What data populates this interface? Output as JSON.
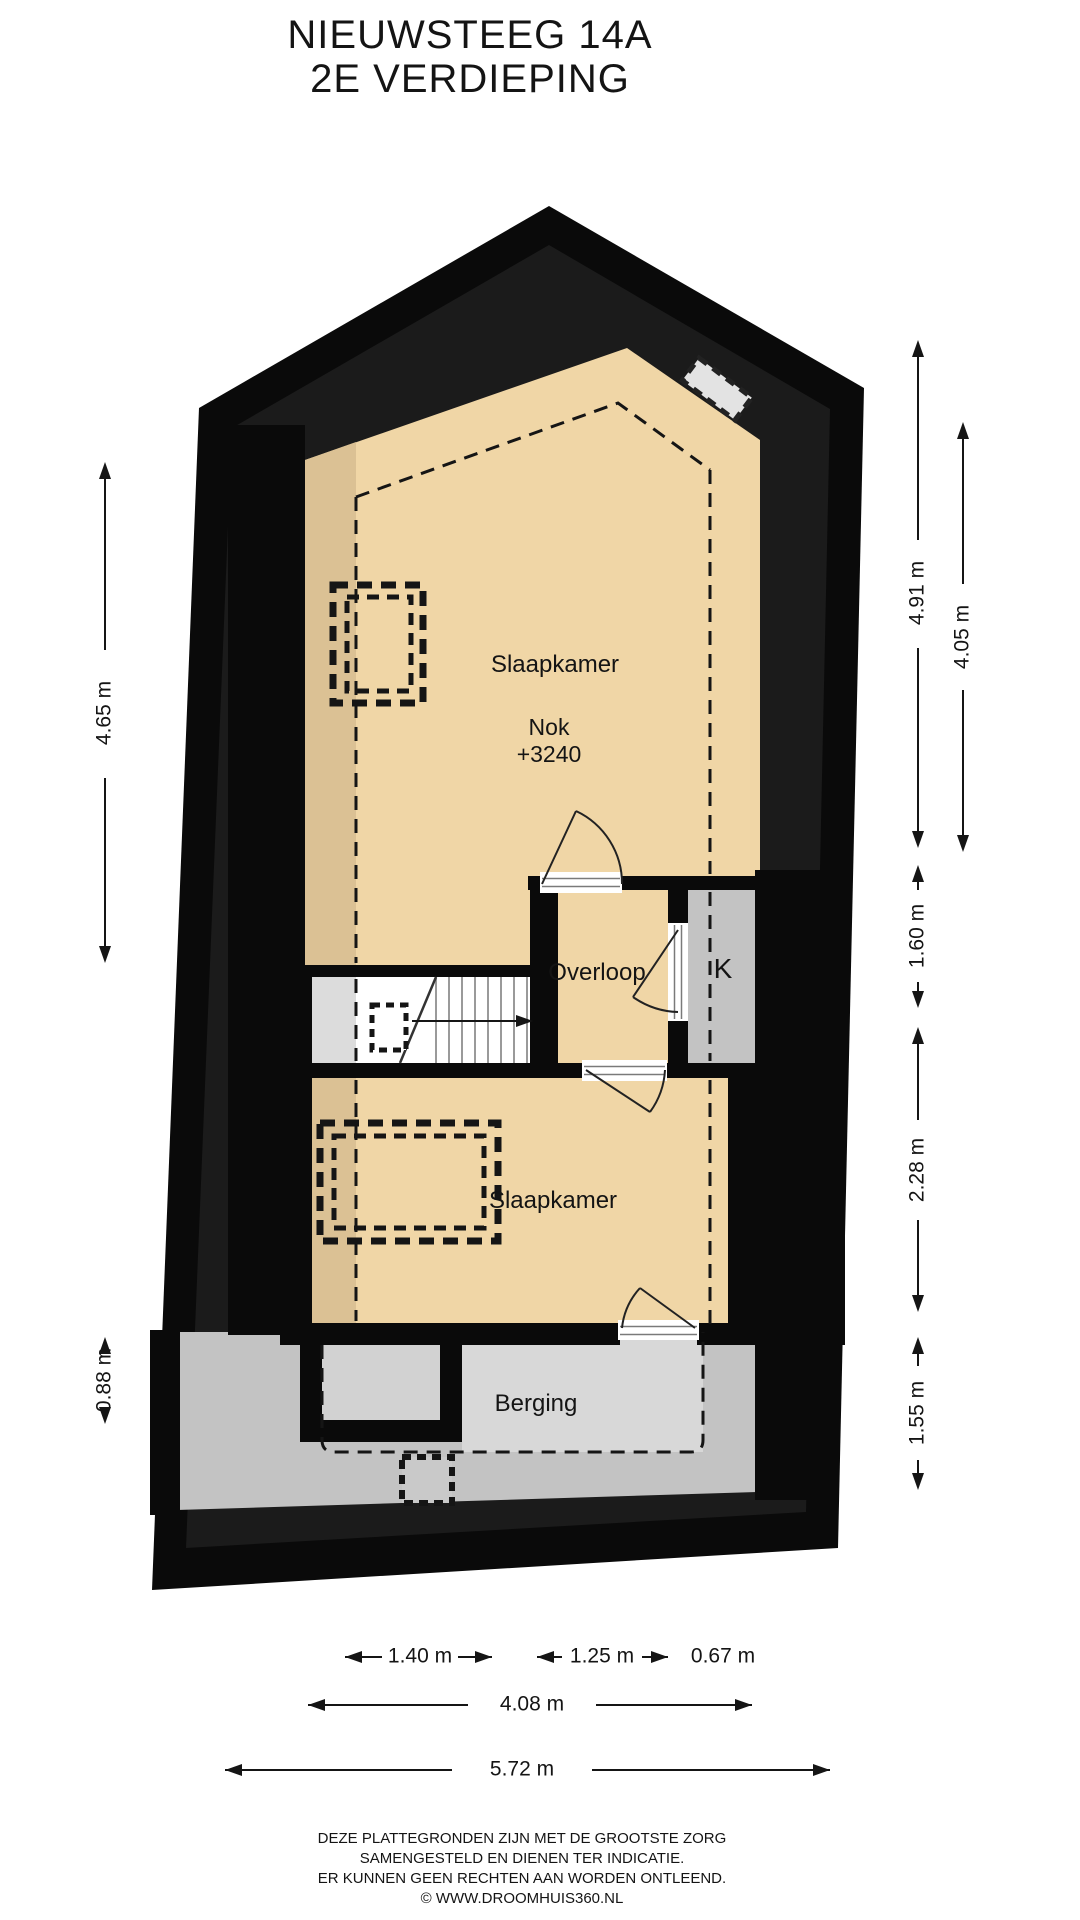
{
  "title": {
    "line1": "NIEUWSTEEG 14A",
    "line2": "2E VERDIEPING"
  },
  "rooms": {
    "bedroom_top": "Slaapkamer",
    "ridge_label": "Nok",
    "ridge_height": "+3240",
    "landing": "Overloop",
    "closet": "K",
    "bedroom_bottom": "Slaapkamer",
    "storage": "Berging"
  },
  "dimensions": {
    "left_upper": "4.65 m",
    "left_lower": "0.88 m",
    "right_1": "4.91 m",
    "right_2": "4.05 m",
    "right_3": "1.60 m",
    "right_4": "2.28 m",
    "right_5": "1.55 m",
    "bottom_a": "1.40 m",
    "bottom_b": "1.25 m",
    "bottom_c": "0.67 m",
    "bottom_inner": "4.08 m",
    "bottom_outer": "5.72 m"
  },
  "footer": {
    "line1": "DEZE PLATTEGRONDEN ZIJN MET DE GROOTSTE ZORG",
    "line2": "SAMENGESTELD EN DIENEN TER INDICATIE.",
    "line3": "ER KUNNEN GEEN RECHTEN AAN WORDEN ONTLEEND.",
    "line4": "© WWW.DROOMHUIS360.NL"
  },
  "colors": {
    "wall": "#0a0a0a",
    "wall_inner": "#1b1b1b",
    "floor_light": "#f0d6a6",
    "floor_shaded": "#dbc194",
    "gray_room": "#c3c3c3",
    "gray_light": "#d8d8d8",
    "stair_side": "#dcdcdc",
    "structure_inner": "#d2d2d2",
    "skylight": "#e3e3e3"
  }
}
